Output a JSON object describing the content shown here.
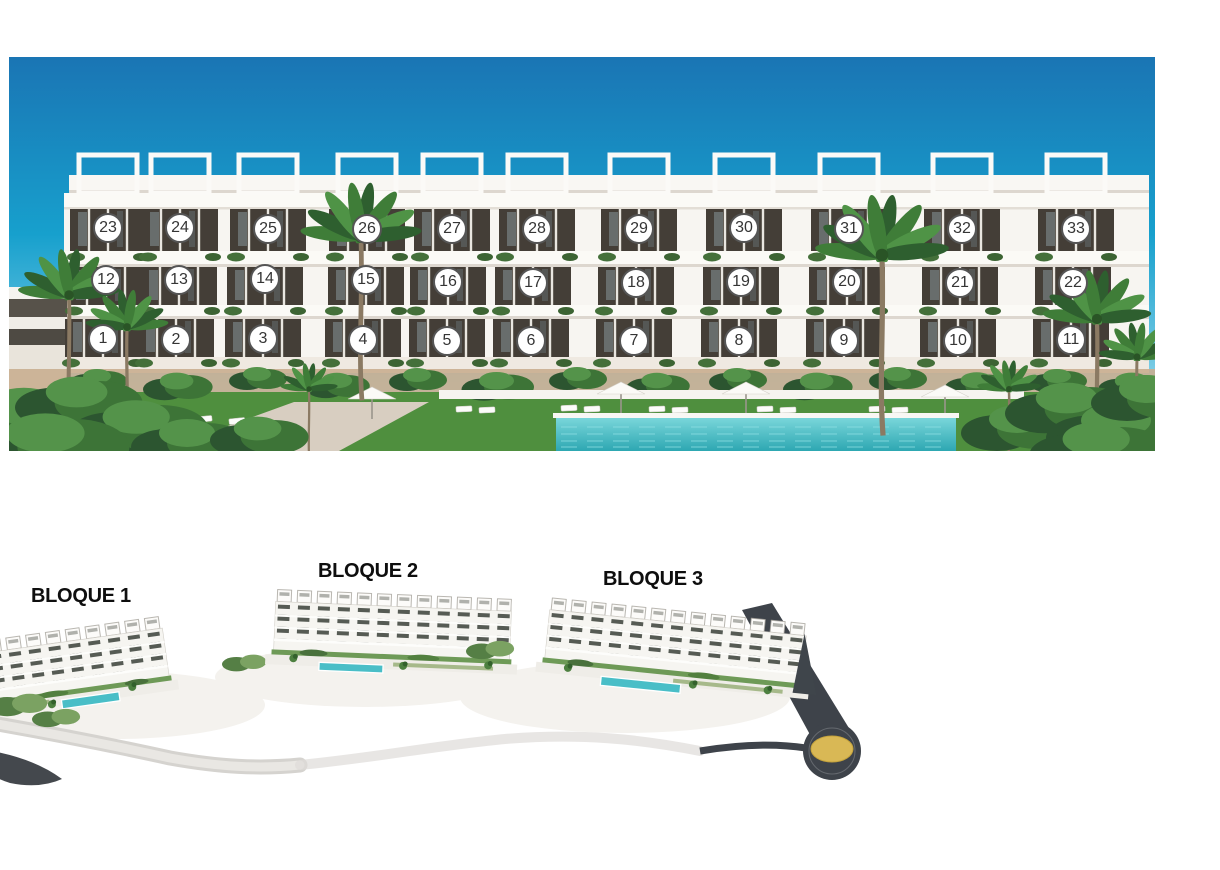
{
  "elevation": {
    "description": "Front elevation render of apartment building with numbered unit markers",
    "markers": [
      {
        "n": "1",
        "x": 94,
        "y": 282
      },
      {
        "n": "2",
        "x": 167,
        "y": 283
      },
      {
        "n": "3",
        "x": 254,
        "y": 282
      },
      {
        "n": "4",
        "x": 354,
        "y": 283
      },
      {
        "n": "5",
        "x": 438,
        "y": 284
      },
      {
        "n": "6",
        "x": 522,
        "y": 284
      },
      {
        "n": "7",
        "x": 625,
        "y": 284
      },
      {
        "n": "8",
        "x": 730,
        "y": 284
      },
      {
        "n": "9",
        "x": 835,
        "y": 284
      },
      {
        "n": "10",
        "x": 949,
        "y": 284
      },
      {
        "n": "11",
        "x": 1062,
        "y": 283
      },
      {
        "n": "12",
        "x": 97,
        "y": 223
      },
      {
        "n": "13",
        "x": 170,
        "y": 223
      },
      {
        "n": "14",
        "x": 256,
        "y": 222
      },
      {
        "n": "15",
        "x": 357,
        "y": 223
      },
      {
        "n": "16",
        "x": 439,
        "y": 225
      },
      {
        "n": "17",
        "x": 524,
        "y": 226
      },
      {
        "n": "18",
        "x": 627,
        "y": 226
      },
      {
        "n": "19",
        "x": 732,
        "y": 225
      },
      {
        "n": "20",
        "x": 838,
        "y": 225
      },
      {
        "n": "21",
        "x": 951,
        "y": 226
      },
      {
        "n": "22",
        "x": 1064,
        "y": 226
      },
      {
        "n": "23",
        "x": 99,
        "y": 171
      },
      {
        "n": "24",
        "x": 171,
        "y": 171
      },
      {
        "n": "25",
        "x": 259,
        "y": 172
      },
      {
        "n": "26",
        "x": 358,
        "y": 172
      },
      {
        "n": "27",
        "x": 443,
        "y": 172
      },
      {
        "n": "28",
        "x": 528,
        "y": 172
      },
      {
        "n": "29",
        "x": 630,
        "y": 172
      },
      {
        "n": "30",
        "x": 735,
        "y": 171
      },
      {
        "n": "31",
        "x": 840,
        "y": 172
      },
      {
        "n": "32",
        "x": 953,
        "y": 172
      },
      {
        "n": "33",
        "x": 1067,
        "y": 172
      }
    ]
  },
  "site_plan": {
    "description": "Aerial site plan render of the three residential blocks",
    "blocks": [
      {
        "label": "BLOQUE 1"
      },
      {
        "label": "BLOQUE 2"
      },
      {
        "label": "BLOQUE 3"
      }
    ]
  },
  "colors": {
    "sky_top": "#1a75b4",
    "sky_mid": "#17a0cd",
    "sky_horizon": "#cdeef6",
    "facade_white": "#f7f5f1",
    "slab_white": "#fbfaf6",
    "glass": "#443e37",
    "glass_reflection": "#9fb3bc",
    "planter_green": "#44703a",
    "sand_wall": "#c9ae90",
    "lawn": "#4f8f3e",
    "pool": "#49bec7",
    "pool_ripple": "#8fe0e3",
    "marker_bg": "#ffffff",
    "marker_border": "#555555",
    "marker_text": "#353535",
    "label_color": "#0e0e0e",
    "road_light": "#d5d3cf",
    "road_dark": "#3e434a",
    "roundabout_gold": "#d9b855",
    "hedge_green": "#6e9a57"
  }
}
